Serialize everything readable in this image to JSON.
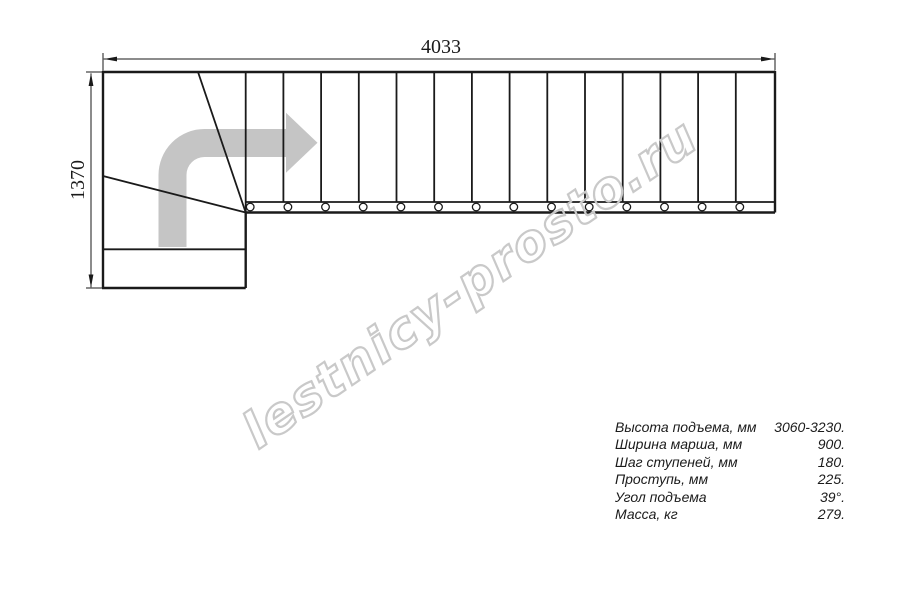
{
  "drawing": {
    "title": "L-shaped staircase plan view",
    "dim_width": "4033",
    "dim_height": "1370",
    "watermark": "lestnicy-prosto.ru",
    "straight_flight_treads": 14,
    "winder_treads": 3,
    "stringer_circles": 14,
    "colors": {
      "line": "#1a1a1a",
      "arrow_gray": "#c5c5c5",
      "watermark_gray": "#c9c9c9",
      "background": "#ffffff"
    }
  },
  "specs": {
    "rows": [
      {
        "label": "Высота подъема, мм",
        "value": "3060-3230."
      },
      {
        "label": "Ширина марша, мм",
        "value": "900."
      },
      {
        "label": "Шаг ступеней, мм",
        "value": "180."
      },
      {
        "label": "Проступь, мм",
        "value": "225."
      },
      {
        "label": "Угол подъема",
        "value": "39°."
      },
      {
        "label": "Масса, кг",
        "value": "279."
      }
    ]
  }
}
